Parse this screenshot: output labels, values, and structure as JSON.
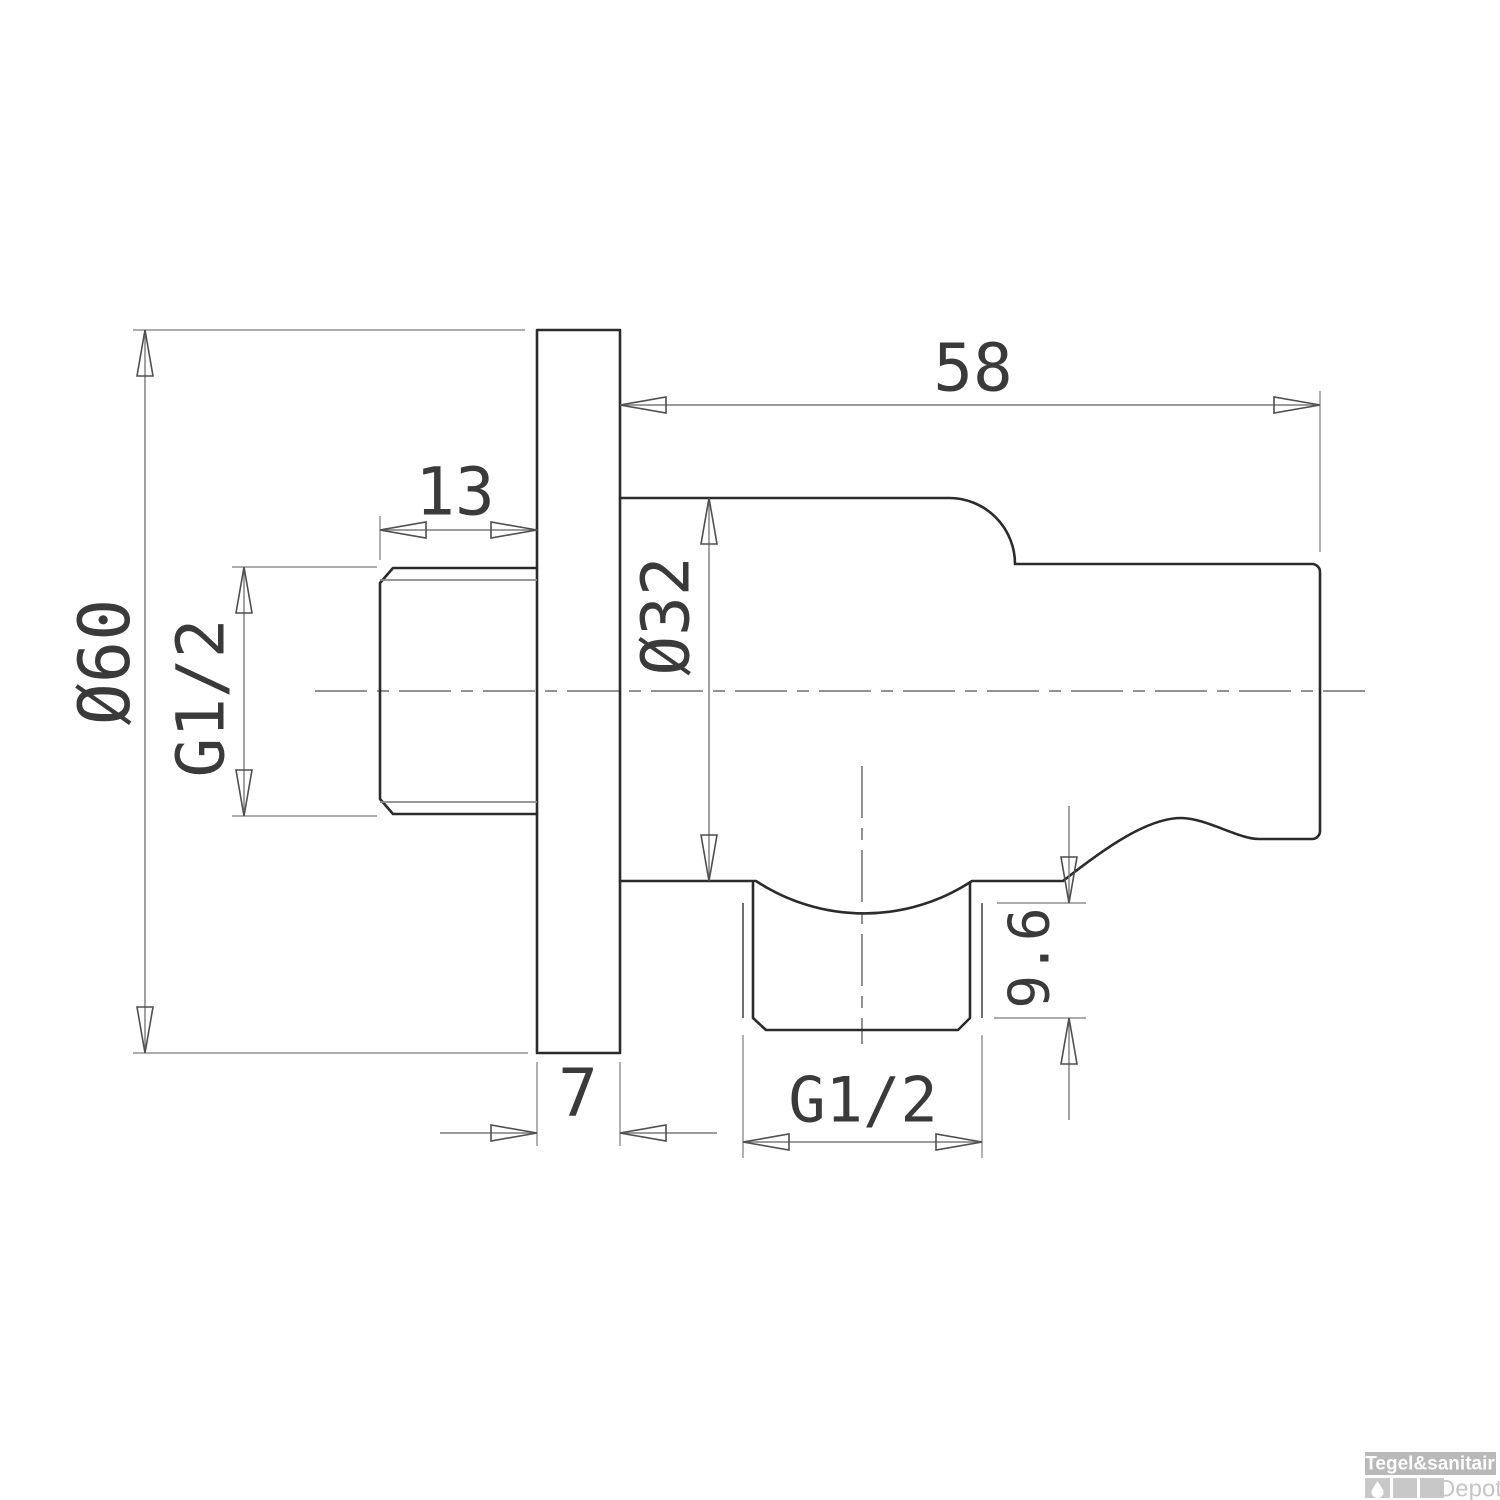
{
  "title": "Wall outlet with hand shower holder - dimensioned technical drawing",
  "dimensions": {
    "flange_diameter": "Ø60",
    "inlet_thread": "G1/2",
    "inlet_thread_length": "13",
    "body_length": "58",
    "body_diameter": "Ø32",
    "holder_thread_depth": "9.6",
    "flange_thickness": "7",
    "outlet_thread": "G1/2"
  },
  "logo": {
    "brand": "Tegel&sanitair",
    "sub_brand": "Depot"
  },
  "colors": {
    "outline": "#2b2b2b",
    "dimension_line": "#7b7b7b",
    "dimension_text": "#3a3a3a",
    "centerline": "#6f6f6f",
    "logo_bar": "#b9b9b9",
    "logo_square": "#c8c8c8",
    "logo_brand_text": "#ffffff",
    "logo_depot_text": "#c5c5c5",
    "background": "#ffffff"
  }
}
